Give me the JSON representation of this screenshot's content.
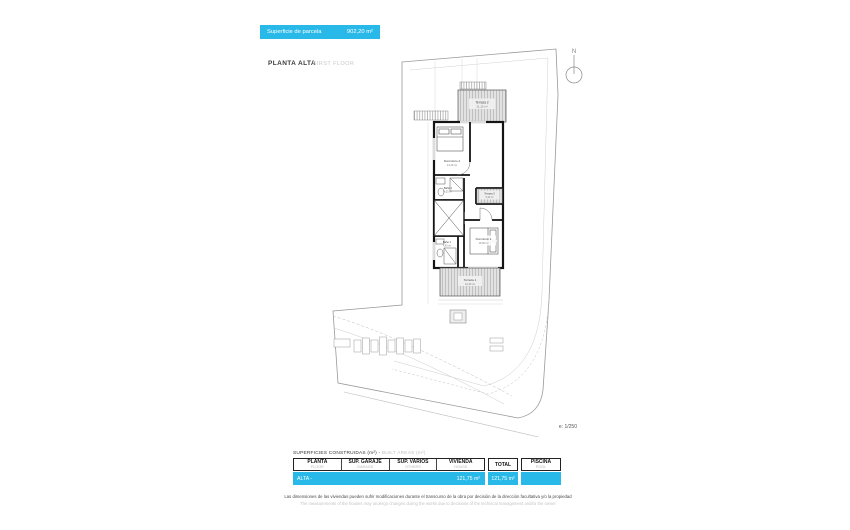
{
  "banner": {
    "label": "Superficie de parcela",
    "value": "902,20 m²"
  },
  "title": {
    "main": "PLANTA ALTA",
    "sub": "FIRST FLOOR"
  },
  "north": {
    "label": "N"
  },
  "plan": {
    "scale": "e: 1/250",
    "rooms": {
      "terraza2": {
        "name": "Terraza 2",
        "area": "21,15 m²"
      },
      "dormitorio2": {
        "name": "Dormitorio 2",
        "area": "14,10 m²"
      },
      "bano2": {
        "name": "Baño 2",
        "area": "4,25 m²"
      },
      "bano1": {
        "name": "Baño 1",
        "area": "4,60 m²"
      },
      "dormitorio1": {
        "name": "Dormitorio 1",
        "area": "16,35 m²"
      },
      "terraza1": {
        "name": "Terraza 1",
        "area": "12,40 m²"
      },
      "terraza3": {
        "name": "Terraza 3",
        "area": "5,10 m²"
      }
    }
  },
  "table": {
    "caption_es": "SUPERFICIES CONSTRUIDAS (m²) - ",
    "caption_en": "BUILT AREAS (m²)",
    "columns": [
      {
        "title": "PLANTA",
        "subtitle": "FLOOR"
      },
      {
        "title": "SUP. GARAJE",
        "subtitle": "GARAGE"
      },
      {
        "title": "SUP. VARIOS",
        "subtitle": "OTHERS"
      },
      {
        "title": "VIVIENDA",
        "subtitle": "HOUSE"
      }
    ],
    "total": {
      "title": "TOTAL"
    },
    "piscina": {
      "title": "PISCINA",
      "subtitle": "POOL"
    },
    "row": {
      "planta": "ALTA -",
      "garaje": "",
      "varios": "",
      "vivienda": "121,75 m²",
      "total": "121,75 m²",
      "piscina": ""
    }
  },
  "footer": {
    "line1": "Las dimensiones de las viviendas pueden sufrir modificaciones durante el transcurso de la obra por decisión de la dirección facultativa y/o la propiedad",
    "line2": "The measurements of the houses may undergo changes during the works due to decisions of the technical management and/or the owner"
  },
  "colors": {
    "accent": "#29B9E8"
  }
}
